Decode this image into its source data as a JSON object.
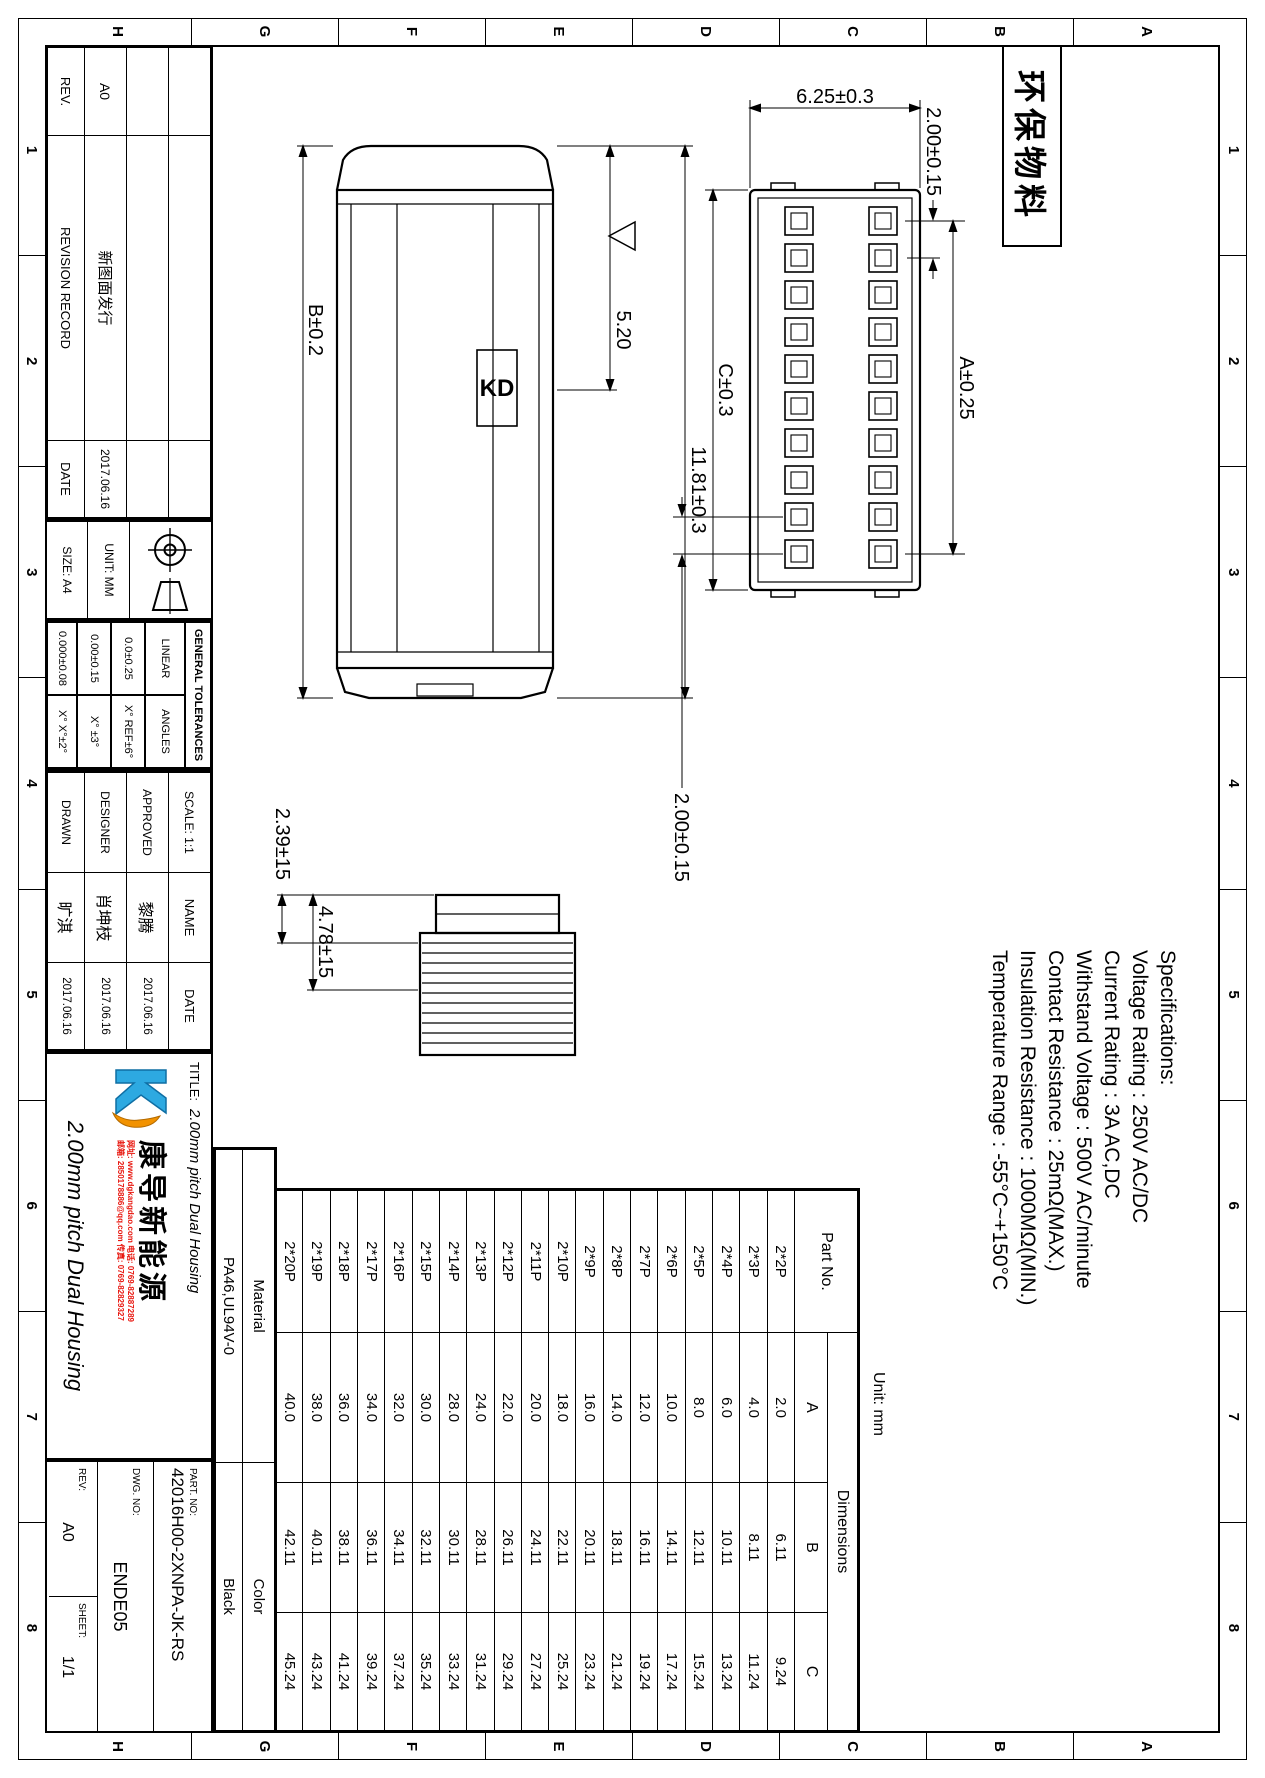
{
  "page": {
    "zone_numbers": [
      "1",
      "2",
      "3",
      "4",
      "5",
      "6",
      "7",
      "8"
    ],
    "zone_letters": [
      "A",
      "B",
      "C",
      "D",
      "E",
      "F",
      "G",
      "H"
    ],
    "eco_stamp": "环保物料"
  },
  "revision_table": {
    "rev_label": "REV.",
    "desc_label": "REVISION RECORD",
    "date_label": "DATE",
    "rev_value": "A0",
    "desc_value": "新图面发行",
    "date_value": "2017.06.16"
  },
  "info": {
    "size_label": "SIZE: A4",
    "unit_label": "UNIT: MM",
    "tolerances": {
      "title": "GENERAL TOLERANCES",
      "linear_label": "LINEAR",
      "angles_label": "ANGLES",
      "linear_1": "0.0±0.25",
      "linear_2": "0.00±0.15",
      "linear_3": "0.000±0.08",
      "angle_1": "X° REF±6°",
      "angle_2": "X° ±3°",
      "angle_3": "X° X°±2°"
    },
    "scale_label": "SCALE:",
    "scale_value": "1:1",
    "name_label": "NAME",
    "date_label": "DATE",
    "approved_label": "APPROVED",
    "approved_name": "黎腾",
    "approved_date": "2017.06.16",
    "designer_label": "DESIGNER",
    "designer_name": "肖坤枝",
    "designer_date": "2017.06.16",
    "drawn_label": "DRAWN",
    "drawn_name": "旷淇",
    "drawn_date": "2017.06.16"
  },
  "title_block": {
    "title_label": "TITLE:",
    "title": "2.00mm pitch Dual Housing",
    "part_no_label": "PART. NO:",
    "part_no": "42016H00-2XNPA-JK-RS",
    "dwg_no_label": "DWG. NO:",
    "dwg_no": "ENDE05",
    "rev_label": "REV:",
    "rev": "A0",
    "sheet_label": "SHEET:",
    "sheet": "1/1",
    "material_label": "Material",
    "material": "PA46,UL94V-0",
    "color_label": "Color",
    "color": "Black",
    "logo": {
      "brand": "康导新能源",
      "contact_line1": "网址: www.dgkangdao.com  电话: 0769-82887289",
      "contact_line2": "邮箱: 2850178886@qq.com  传真: 0769-82829327"
    },
    "accent_blue": "#2da9e1",
    "accent_orange": "#f29200",
    "accent_red": "#e8150d"
  },
  "specifications": {
    "title": "Specifications:",
    "lines": [
      "Voltage Rating : 250V AC/DC",
      "Current Rating : 3A AC,DC",
      "Withstand Voltage : 500V AC/minute",
      "Contact Resistance : 25mΩ(MAX.)",
      "Insulation Resistance : 1000MΩ(MIN.)",
      "Temperature Range : -55°C~+150°C"
    ]
  },
  "dimensions": {
    "dim_625": "6.25±0.3",
    "dim_200_top": "2.00±0.15",
    "dim_a": "A±0.25",
    "dim_c": "C±0.3",
    "dim_200_bottom": "2.00±0.15",
    "dim_b": "B±0.2",
    "dim_520": "5.20",
    "dim_1181": "11.81±0.3",
    "dim_239": "2.39±15",
    "dim_478": "4.78±15",
    "kd_mark": "KD"
  },
  "front_view": {
    "rows": 2,
    "cols": 10
  },
  "parts_table": {
    "unit_note": "Unit: mm",
    "part_no_header": "Part No.",
    "dimensions_header": "Dimensions",
    "col_a": "A",
    "col_b": "B",
    "col_c": "C",
    "rows": [
      {
        "part": "2*2P",
        "a": "2.0",
        "b": "6.11",
        "c": "9.24"
      },
      {
        "part": "2*3P",
        "a": "4.0",
        "b": "8.11",
        "c": "11.24"
      },
      {
        "part": "2*4P",
        "a": "6.0",
        "b": "10.11",
        "c": "13.24"
      },
      {
        "part": "2*5P",
        "a": "8.0",
        "b": "12.11",
        "c": "15.24"
      },
      {
        "part": "2*6P",
        "a": "10.0",
        "b": "14.11",
        "c": "17.24"
      },
      {
        "part": "2*7P",
        "a": "12.0",
        "b": "16.11",
        "c": "19.24"
      },
      {
        "part": "2*8P",
        "a": "14.0",
        "b": "18.11",
        "c": "21.24"
      },
      {
        "part": "2*9P",
        "a": "16.0",
        "b": "20.11",
        "c": "23.24"
      },
      {
        "part": "2*10P",
        "a": "18.0",
        "b": "22.11",
        "c": "25.24"
      },
      {
        "part": "2*11P",
        "a": "20.0",
        "b": "24.11",
        "c": "27.24"
      },
      {
        "part": "2*12P",
        "a": "22.0",
        "b": "26.11",
        "c": "29.24"
      },
      {
        "part": "2*13P",
        "a": "24.0",
        "b": "28.11",
        "c": "31.24"
      },
      {
        "part": "2*14P",
        "a": "28.0",
        "b": "30.11",
        "c": "33.24"
      },
      {
        "part": "2*15P",
        "a": "30.0",
        "b": "32.11",
        "c": "35.24"
      },
      {
        "part": "2*16P",
        "a": "32.0",
        "b": "34.11",
        "c": "37.24"
      },
      {
        "part": "2*17P",
        "a": "34.0",
        "b": "36.11",
        "c": "39.24"
      },
      {
        "part": "2*18P",
        "a": "36.0",
        "b": "38.11",
        "c": "41.24"
      },
      {
        "part": "2*19P",
        "a": "38.0",
        "b": "40.11",
        "c": "43.24"
      },
      {
        "part": "2*20P",
        "a": "40.0",
        "b": "42.11",
        "c": "45.24"
      }
    ]
  }
}
